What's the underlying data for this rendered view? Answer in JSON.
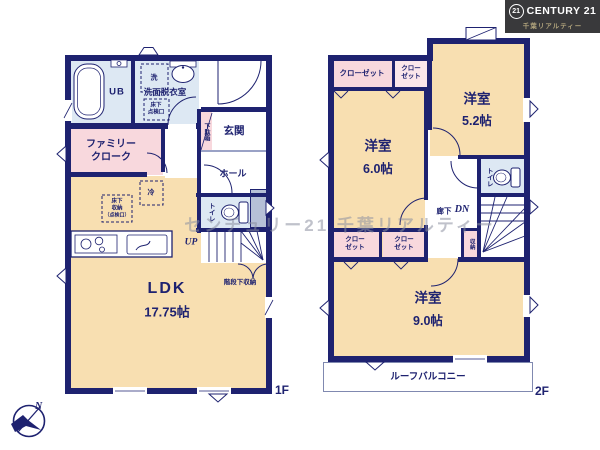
{
  "branding": {
    "logo_badge": "21",
    "logo_name": "CENTURY 21",
    "logo_subtitle": "千葉リアルティー"
  },
  "watermark": "センチュリー21 千葉リアルティー",
  "compass": {
    "north": "N"
  },
  "colors": {
    "wall_navy": "#1e2270",
    "room_beige": "#f8dfb1",
    "room_pink": "#f8d8dd",
    "room_blue": "#dde8f3"
  },
  "floor1": {
    "label": "1F",
    "rooms": {
      "ub": "UB",
      "washroom": "洗面脱衣室",
      "entrance": "玄関",
      "hall": "ホール",
      "toilet": "トイレ",
      "family_cloak_l1": "ファミリー",
      "family_cloak_l2": "クローク",
      "ldk_name": "LDK",
      "ldk_size": "17.75帖"
    },
    "annotations": {
      "washer": "洗",
      "fridge": "冷",
      "underfloor_access_l1": "床下",
      "underfloor_access_l2": "点検口",
      "underfloor_storage_l1": "床下",
      "underfloor_storage_l2": "収納",
      "underfloor_storage_l3": "（点検口）",
      "shoe_box": "下駄箱",
      "up": "UP",
      "under_stairs_storage": "階段下収納"
    }
  },
  "floor2": {
    "label": "2F",
    "rooms": {
      "bedroom52_name": "洋室",
      "bedroom52_size": "5.2帖",
      "bedroom60_name": "洋室",
      "bedroom60_size": "6.0帖",
      "bedroom90_name": "洋室",
      "bedroom90_size": "9.0帖",
      "closet_wide": "クローゼット",
      "closet_small_l1": "クロー",
      "closet_small_l2": "ゼット",
      "closet_c_l1": "クロー",
      "closet_c_l2": "ゼット",
      "closet_d_l1": "クロー",
      "closet_d_l2": "ゼット",
      "toilet": "トイレ",
      "storage": "収納",
      "corridor": "廊下",
      "down": "DN",
      "roof_balcony": "ルーフバルコニー"
    }
  }
}
